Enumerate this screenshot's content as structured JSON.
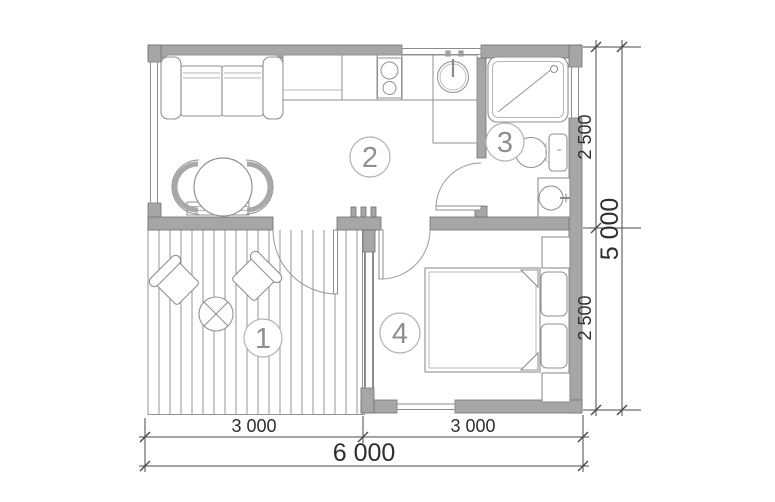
{
  "floor_plan": {
    "room_labels": [
      "1",
      "2",
      "3",
      "4"
    ],
    "dimension_labels": {
      "right_segments": [
        "2 500",
        "2 500"
      ],
      "right_total": "5 000",
      "bottom_segments": [
        "3 000",
        "3 000"
      ],
      "bottom_total": "6 000"
    },
    "colors": {
      "wall_fill": "#a6a6a6",
      "wall_stroke": "#6f6f6f",
      "furniture_stroke": "#909090",
      "dimension_line": "#4a4a4a",
      "dimension_text": "#2e2e2e",
      "room_number_text": "#8f8f8f",
      "background": "#ffffff"
    }
  }
}
